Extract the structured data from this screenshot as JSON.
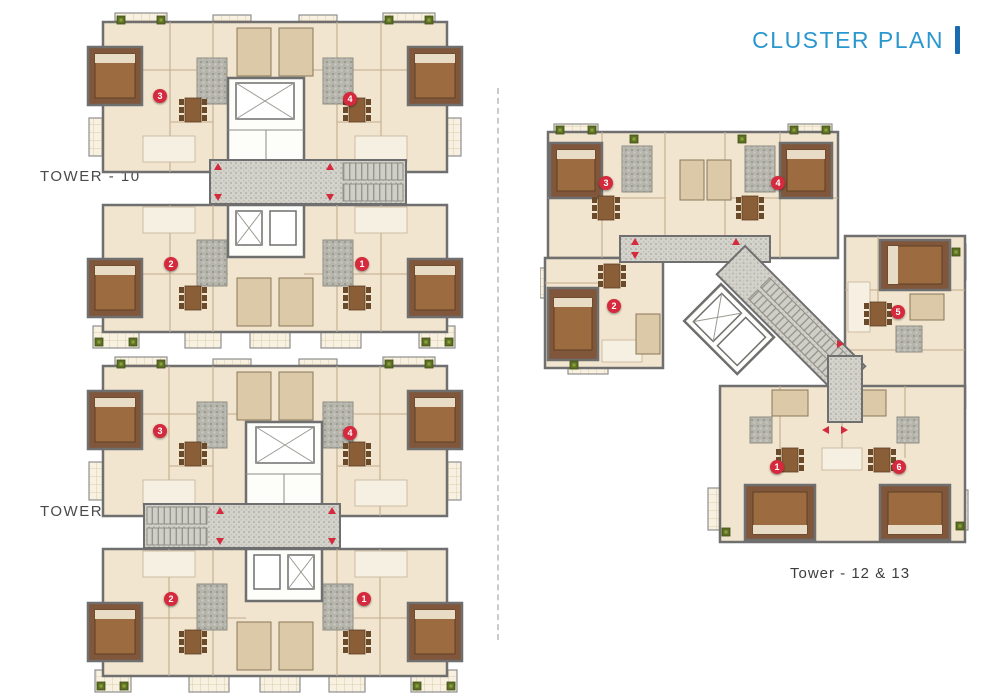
{
  "header": {
    "title": "CLUSTER PLAN"
  },
  "labels": {
    "tower10": "TOWER - 10",
    "tower11": "TOWER - 11",
    "tower12_13": "Tower - 12 & 13"
  },
  "colors": {
    "title_blue": "#2a97cf",
    "title_bar_blue": "#1a6cb0",
    "label_gray": "#4a4a4a",
    "marker_red": "#d5293d",
    "floor_cream": "#f2e5cf",
    "wall_gray": "#6f6f6f",
    "bedroom_brown": "#80573a"
  },
  "unit_markers": {
    "tower10": [
      {
        "n": "3",
        "x": 160,
        "y": 96
      },
      {
        "n": "4",
        "x": 350,
        "y": 99
      },
      {
        "n": "2",
        "x": 171,
        "y": 264
      },
      {
        "n": "1",
        "x": 362,
        "y": 264
      }
    ],
    "tower11": [
      {
        "n": "3",
        "x": 160,
        "y": 431
      },
      {
        "n": "4",
        "x": 350,
        "y": 433
      },
      {
        "n": "2",
        "x": 171,
        "y": 599
      },
      {
        "n": "1",
        "x": 364,
        "y": 599
      }
    ],
    "tower12_13": [
      {
        "n": "3",
        "x": 606,
        "y": 183
      },
      {
        "n": "4",
        "x": 778,
        "y": 183
      },
      {
        "n": "2",
        "x": 614,
        "y": 306
      },
      {
        "n": "5",
        "x": 898,
        "y": 312
      },
      {
        "n": "1",
        "x": 777,
        "y": 467
      },
      {
        "n": "6",
        "x": 899,
        "y": 467
      }
    ]
  }
}
